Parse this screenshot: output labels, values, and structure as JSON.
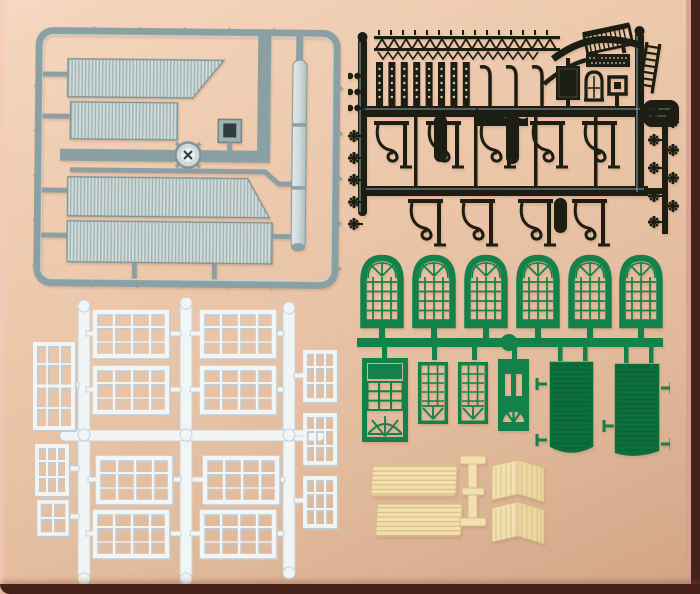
{
  "scene": {
    "type": "product-photo",
    "subject": "Plastic model railway building kit sprues laid out on a beige background",
    "background": "warm beige paper with pink tint at top-left and dark brown shadow borders at bottom and right"
  },
  "colors": {
    "bg_top": "#f6d8c0",
    "bg_mid": "#eac5a8",
    "bg_bottom": "#d8ad8f",
    "border_brown": "#45211a",
    "border_pink": "#d79e90",
    "gray_runner": "#8ba0a3",
    "gray_frame_hi": "#c9d4d4",
    "gray_panel_light": "#d3dcdb",
    "gray_panel_dark": "#a0b5b2",
    "gray_part_dark": "#2f3b3c",
    "pipe_light": "#e4eaea",
    "pipe_shade": "#aebfc0",
    "black_plastic": "#1c1e13",
    "black_sheen": "#7d9398",
    "black_inner_line": "#3e4134",
    "green_plastic": "#12824a",
    "green_dark": "#0c6e3d",
    "green_slat": "#0a5c33",
    "white_plastic": "#f1f5f6",
    "white_shadow": "#c0ccd2",
    "cream_plastic": "#f3e0b0",
    "cream_face_dark": "#ecd7a0",
    "cream_line": "#d8bc84"
  },
  "sprues": {
    "gray": {
      "name": "Roof and chimney sprue",
      "material": "silver-gray plastic",
      "parts": [
        "large corrugated roof panel with angled edge",
        "small corrugated roof panel",
        "two long corrugated roof panels",
        "station clock",
        "chimney head",
        "long chimney pipe",
        "rectangular runner frame with gate tabs"
      ]
    },
    "black": {
      "name": "Platform canopy sprue",
      "material": "black plastic",
      "parts": [
        "lattice valance strip",
        "eight fretwork column strips",
        "three curved hanger arms",
        "panelled door",
        "arched window",
        "square skylight frame",
        "slatted bench",
        "ladder",
        "rounded roof block",
        "three column halves",
        "nine ornate canopy brackets",
        "flower rosette details"
      ]
    },
    "green": {
      "name": "Green windows and doors sprue",
      "material": "green plastic",
      "parts": [
        "six arched multi-pane windows",
        "panelled door with fanlight",
        "two small multi-pane windows",
        "door with two lights and fanlight",
        "two planked gate doors with side pins"
      ]
    },
    "white": {
      "name": "White window sprue",
      "material": "white plastic",
      "parts": [
        "eight large four-light windows",
        "tall double window",
        "three small windows on the right runner",
        "small window and tiny window on the left"
      ]
    },
    "cream": {
      "name": "Bench parts",
      "material": "cream plastic",
      "parts": [
        "two slatted seat boards",
        "bench support trestle",
        "two folded slatted back boards"
      ]
    }
  }
}
